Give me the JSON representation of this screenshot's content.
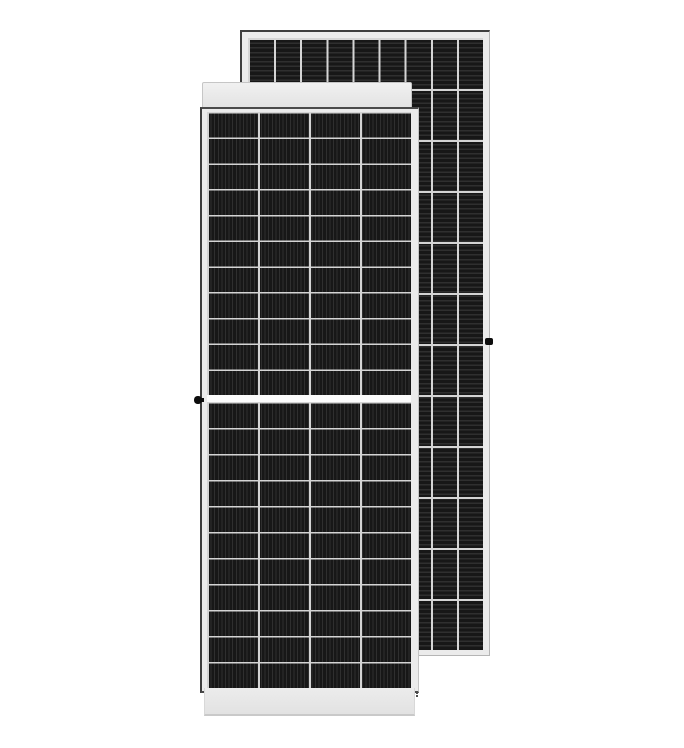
{
  "scene": {
    "type": "product-photo",
    "subject": "Two overlapping monocrystalline solar PV modules: front face of one panel in the foreground, rear face of a second panel behind it to the right",
    "background_color": "#ffffff"
  },
  "colors": {
    "background": "#ffffff",
    "cell_base": "#171717",
    "cell_stripe": "#2f2f2f",
    "grid_line": "#d4d4d4",
    "frame_fill": "#ebebeb",
    "band_light": "#f1f1f1",
    "band_dark": "#e2e2e2",
    "outline_dark": "#3d3d3d",
    "edge_light": "#b5b5b5",
    "screw": "#0d0d0d"
  },
  "panels": {
    "front": {
      "name": "front-module",
      "columns": 4,
      "rows_top_half": 11,
      "rows_bottom_half": 11,
      "busbar_stripe_direction": "vertical",
      "center_divider": true,
      "frame_screw_side": "left"
    },
    "back": {
      "name": "rear-module",
      "columns": 9,
      "rows": 12,
      "busbar_stripe_direction": "horizontal",
      "center_divider": false,
      "frame_screw_side": "right"
    }
  }
}
